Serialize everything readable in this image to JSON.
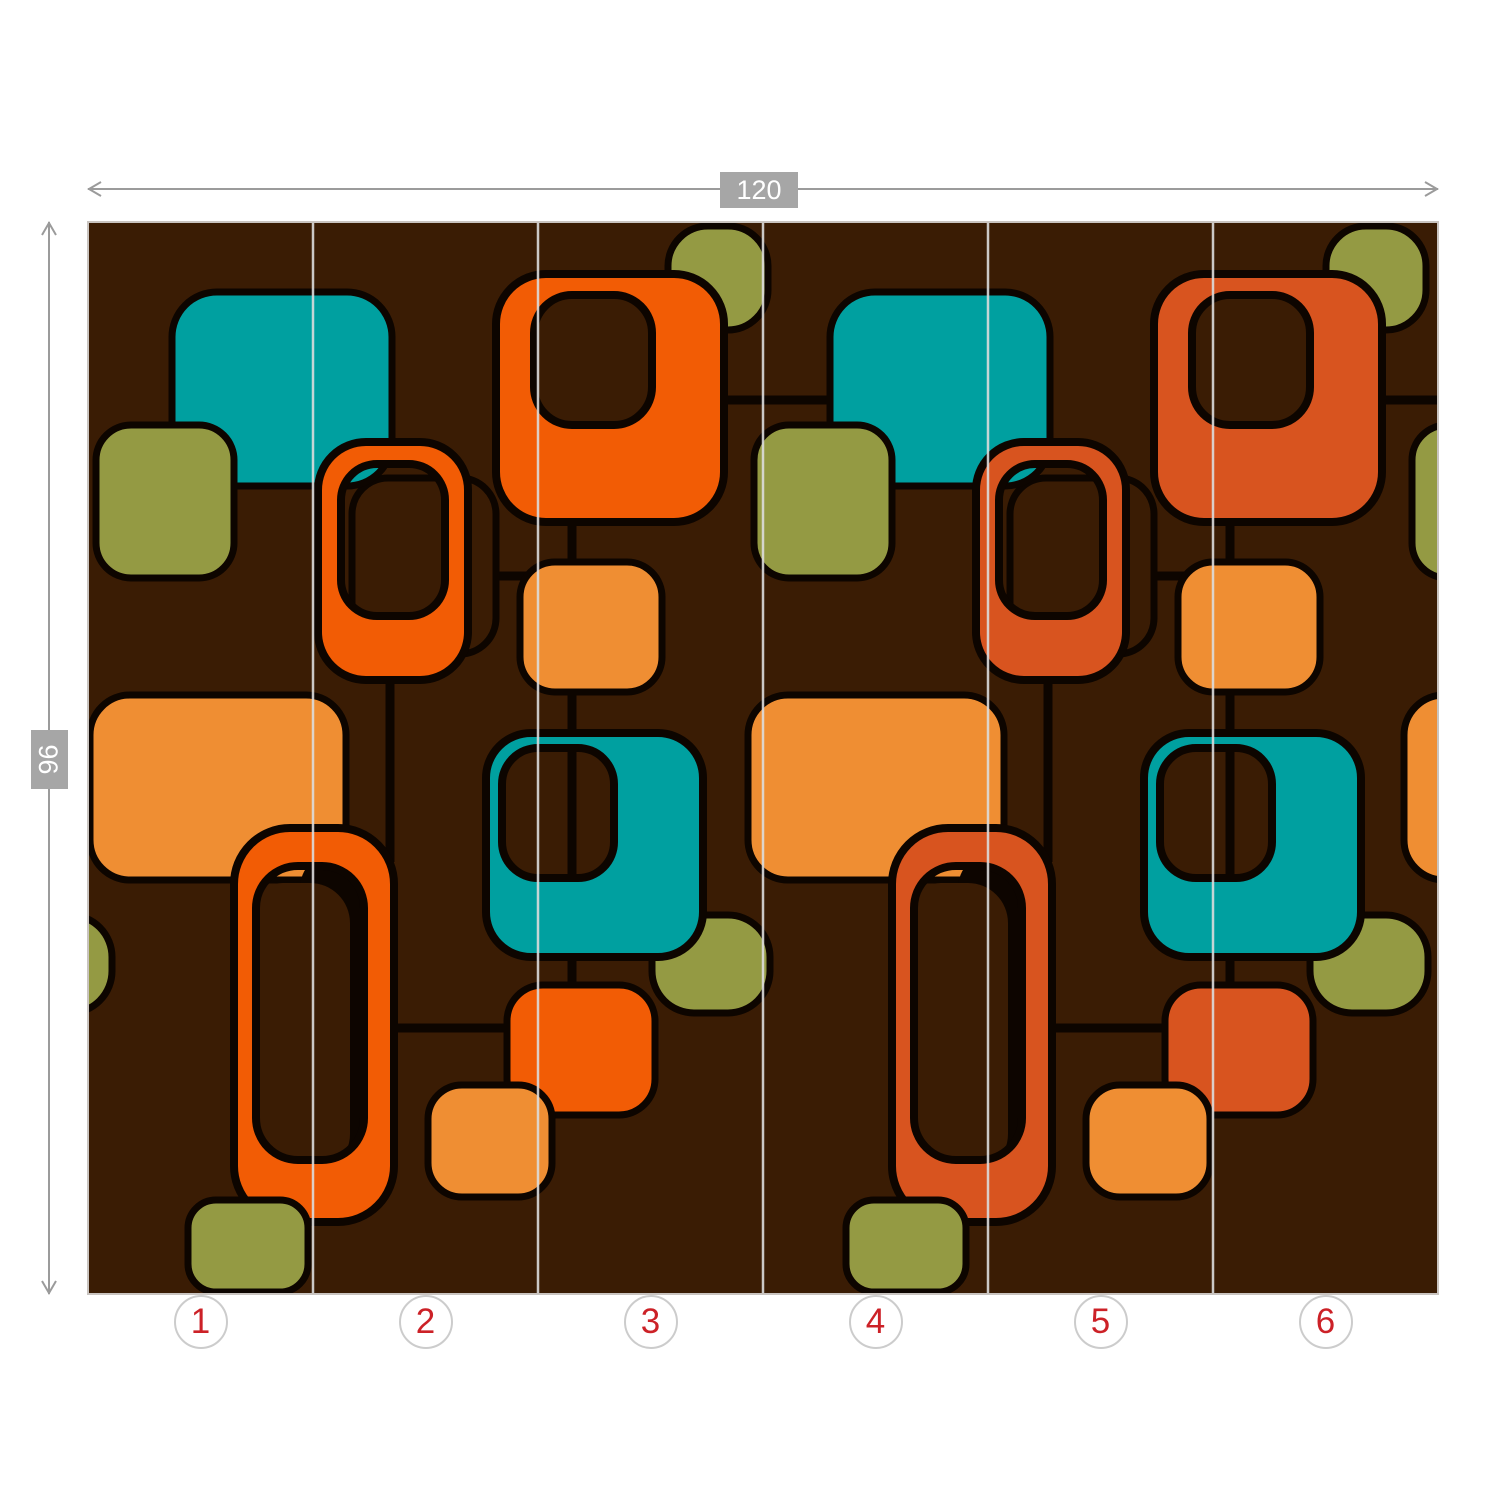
{
  "page": {
    "background": "#ffffff"
  },
  "dimensions": {
    "width_label": "120",
    "height_label": "96",
    "line_color": "#9b9b9b",
    "label_bg": "#a6a6a6",
    "label_text_color": "#ffffff"
  },
  "panels": {
    "numbers": [
      "1",
      "2",
      "3",
      "4",
      "5",
      "6"
    ],
    "number_color": "#cc2127",
    "circle_border_color": "#cccccc",
    "circle_fill": "#ffffff"
  },
  "mural": {
    "x": 88,
    "y": 222,
    "width": 1350,
    "height": 1072,
    "border_color": "#c9c4c0",
    "divider_color": "#dcdcdc",
    "divider_positions": [
      225,
      450,
      675,
      900,
      1125
    ],
    "palette": {
      "brown": "#3a1c04",
      "black": "#0d0500",
      "teal": "#00a0a0",
      "orange": "#f25c05",
      "redorange": "#d8541f",
      "lightorange": "#ef8e33",
      "olive": "#949a43"
    },
    "shapes": [
      {
        "name": "connector-line",
        "t": "line",
        "x1": 634,
        "y1": 178,
        "x2": 762,
        "y2": 178
      },
      {
        "name": "connector-line",
        "t": "line",
        "x1": 1292,
        "y1": 178,
        "x2": 1350,
        "y2": 178
      },
      {
        "name": "connector-line",
        "t": "line",
        "x1": 484,
        "y1": 288,
        "x2": 484,
        "y2": 778
      },
      {
        "name": "connector-line",
        "t": "line",
        "x1": 342,
        "y1": 354,
        "x2": 484,
        "y2": 354
      },
      {
        "name": "connector-line",
        "t": "line",
        "x1": 302,
        "y1": 446,
        "x2": 302,
        "y2": 640
      },
      {
        "name": "connector-line",
        "t": "line",
        "x1": 304,
        "y1": 806,
        "x2": 424,
        "y2": 806
      },
      {
        "name": "connector-line",
        "t": "line",
        "x1": 1142,
        "y1": 288,
        "x2": 1142,
        "y2": 778
      },
      {
        "name": "connector-line",
        "t": "line",
        "x1": 1000,
        "y1": 354,
        "x2": 1142,
        "y2": 354
      },
      {
        "name": "connector-line",
        "t": "line",
        "x1": 960,
        "y1": 446,
        "x2": 960,
        "y2": 640
      },
      {
        "name": "connector-line",
        "t": "line",
        "x1": 962,
        "y1": 806,
        "x2": 1082,
        "y2": 806
      },
      {
        "name": "olive-pill-edge",
        "t": "rect",
        "x": -94,
        "y": 693,
        "w": 118,
        "h": 98,
        "r": 42,
        "c": "olive"
      },
      {
        "name": "olive-square-top",
        "t": "rect",
        "x": 580,
        "y": 4,
        "w": 100,
        "h": 104,
        "r": 40,
        "c": "olive"
      },
      {
        "name": "orange-frame-square",
        "t": "ring",
        "x": 408,
        "y": 52,
        "w": 228,
        "h": 248,
        "r": 50,
        "hx": 446,
        "hy": 73,
        "hw": 118,
        "hh": 130,
        "hr": 38,
        "c": "orange"
      },
      {
        "name": "lightorange-square-small",
        "t": "rect",
        "x": 432,
        "y": 340,
        "w": 142,
        "h": 130,
        "r": 35,
        "c": "lightorange"
      },
      {
        "name": "shadow-rect",
        "t": "rect",
        "x": 264,
        "y": 256,
        "w": 144,
        "h": 176,
        "r": 36,
        "c": "brown"
      },
      {
        "name": "teal-square-top",
        "t": "rect",
        "x": 84,
        "y": 70,
        "w": 220,
        "h": 194,
        "r": 45,
        "c": "teal"
      },
      {
        "name": "olive-square-left",
        "t": "rect",
        "x": 8,
        "y": 203,
        "w": 138,
        "h": 153,
        "r": 35,
        "c": "olive"
      },
      {
        "name": "orange-ring-small",
        "t": "ring",
        "x": 230,
        "y": 220,
        "w": 150,
        "h": 238,
        "r": 48,
        "hx": 253,
        "hy": 242,
        "hw": 104,
        "hh": 152,
        "hr": 36,
        "c": "orange"
      },
      {
        "name": "lightorange-rect-large",
        "t": "rect",
        "x": 2,
        "y": 473,
        "w": 256,
        "h": 185,
        "r": 40,
        "c": "lightorange"
      },
      {
        "name": "ring-shadow-dark",
        "t": "rect",
        "x": 212,
        "y": 631,
        "w": 94,
        "h": 300,
        "r": 35,
        "c": "black",
        "sw": 0
      },
      {
        "name": "ring-shadow-cover",
        "t": "rect",
        "x": 155,
        "y": 661,
        "w": 107,
        "h": 291,
        "r": 40,
        "c": "brown",
        "sw": 0
      },
      {
        "name": "orange-ring-large",
        "t": "ring",
        "x": 146,
        "y": 606,
        "w": 160,
        "h": 394,
        "r": 56,
        "hx": 168,
        "hy": 644,
        "hw": 108,
        "hh": 294,
        "hr": 42,
        "c": "orange"
      },
      {
        "name": "olive-pill",
        "t": "rect",
        "x": 564,
        "y": 693,
        "w": 118,
        "h": 98,
        "r": 42,
        "c": "olive"
      },
      {
        "name": "teal-frame-square",
        "t": "ring",
        "x": 398,
        "y": 511,
        "w": 217,
        "h": 224,
        "r": 45,
        "hx": 414,
        "hy": 526,
        "hw": 112,
        "hh": 130,
        "hr": 36,
        "c": "teal"
      },
      {
        "name": "orange-square-small",
        "t": "rect",
        "x": 419,
        "y": 763,
        "w": 148,
        "h": 130,
        "r": 36,
        "c": "orange"
      },
      {
        "name": "lightorange-rect-small",
        "t": "rect",
        "x": 340,
        "y": 863,
        "w": 124,
        "h": 112,
        "r": 34,
        "c": "lightorange"
      },
      {
        "name": "olive-square-bottom",
        "t": "rect",
        "x": 100,
        "y": 978,
        "w": 120,
        "h": 92,
        "r": 28,
        "c": "olive"
      },
      {
        "name": "olive-square-top",
        "t": "rect",
        "x": 1238,
        "y": 4,
        "w": 100,
        "h": 104,
        "r": 40,
        "c": "olive"
      },
      {
        "name": "redorange-frame-square",
        "t": "ring",
        "x": 1066,
        "y": 52,
        "w": 228,
        "h": 248,
        "r": 50,
        "hx": 1104,
        "hy": 73,
        "hw": 118,
        "hh": 130,
        "hr": 38,
        "c": "redorange"
      },
      {
        "name": "lightorange-square-small",
        "t": "rect",
        "x": 1090,
        "y": 340,
        "w": 142,
        "h": 130,
        "r": 35,
        "c": "lightorange"
      },
      {
        "name": "shadow-rect",
        "t": "rect",
        "x": 922,
        "y": 256,
        "w": 144,
        "h": 176,
        "r": 36,
        "c": "brown"
      },
      {
        "name": "teal-square-top",
        "t": "rect",
        "x": 742,
        "y": 70,
        "w": 220,
        "h": 194,
        "r": 45,
        "c": "teal"
      },
      {
        "name": "olive-square-left",
        "t": "rect",
        "x": 666,
        "y": 203,
        "w": 138,
        "h": 153,
        "r": 35,
        "c": "olive"
      },
      {
        "name": "redorange-ring-small",
        "t": "ring",
        "x": 888,
        "y": 220,
        "w": 150,
        "h": 238,
        "r": 48,
        "hx": 911,
        "hy": 242,
        "hw": 104,
        "hh": 152,
        "hr": 36,
        "c": "redorange"
      },
      {
        "name": "lightorange-rect-large",
        "t": "rect",
        "x": 660,
        "y": 473,
        "w": 256,
        "h": 185,
        "r": 40,
        "c": "lightorange"
      },
      {
        "name": "ring-shadow-dark",
        "t": "rect",
        "x": 870,
        "y": 631,
        "w": 94,
        "h": 300,
        "r": 35,
        "c": "black",
        "sw": 0
      },
      {
        "name": "ring-shadow-cover",
        "t": "rect",
        "x": 813,
        "y": 661,
        "w": 107,
        "h": 291,
        "r": 40,
        "c": "brown",
        "sw": 0
      },
      {
        "name": "redorange-ring-large",
        "t": "ring",
        "x": 804,
        "y": 606,
        "w": 160,
        "h": 394,
        "r": 56,
        "hx": 826,
        "hy": 644,
        "hw": 108,
        "hh": 294,
        "hr": 42,
        "c": "redorange"
      },
      {
        "name": "olive-pill",
        "t": "rect",
        "x": 1222,
        "y": 693,
        "w": 118,
        "h": 98,
        "r": 42,
        "c": "olive"
      },
      {
        "name": "teal-frame-square",
        "t": "ring",
        "x": 1056,
        "y": 511,
        "w": 217,
        "h": 224,
        "r": 45,
        "hx": 1072,
        "hy": 526,
        "hw": 112,
        "hh": 130,
        "hr": 36,
        "c": "teal"
      },
      {
        "name": "redorange-square-small",
        "t": "rect",
        "x": 1077,
        "y": 763,
        "w": 148,
        "h": 130,
        "r": 36,
        "c": "redorange"
      },
      {
        "name": "lightorange-rect-small",
        "t": "rect",
        "x": 998,
        "y": 863,
        "w": 124,
        "h": 112,
        "r": 34,
        "c": "lightorange"
      },
      {
        "name": "olive-square-bottom",
        "t": "rect",
        "x": 758,
        "y": 978,
        "w": 120,
        "h": 92,
        "r": 28,
        "c": "olive"
      },
      {
        "name": "olive-square-edge",
        "t": "rect",
        "x": 1324,
        "y": 203,
        "w": 138,
        "h": 153,
        "r": 35,
        "c": "olive"
      },
      {
        "name": "lightorange-rect-edge",
        "t": "rect",
        "x": 1316,
        "y": 473,
        "w": 256,
        "h": 185,
        "r": 40,
        "c": "lightorange"
      }
    ]
  }
}
